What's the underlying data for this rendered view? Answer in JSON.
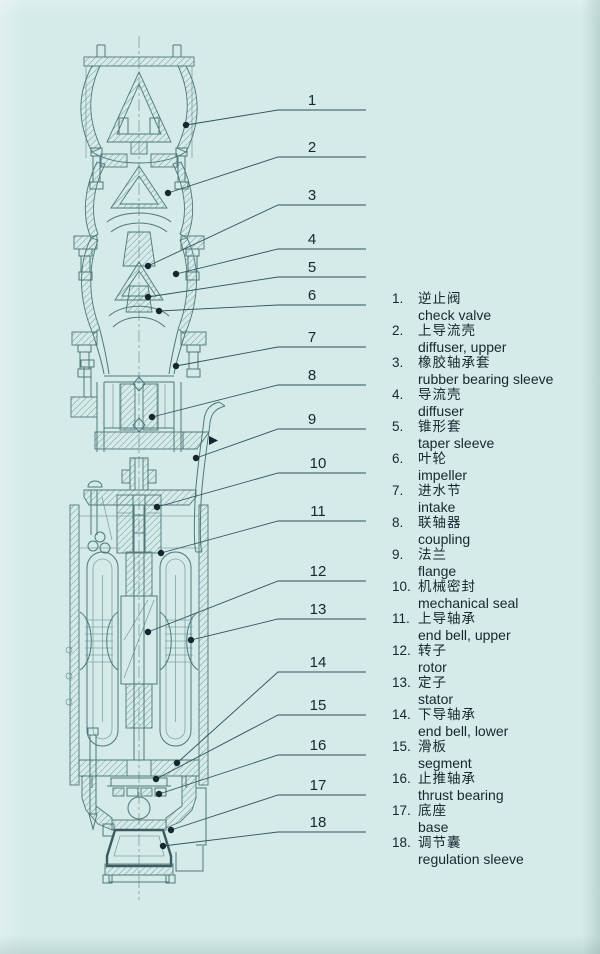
{
  "figure": {
    "kind": "submersible pump cross-section diagram",
    "colors": {
      "paper": "#d4ebe9",
      "drawing_line": "#4f7779",
      "leader_line": "#31515c",
      "text": "#17262f"
    }
  },
  "callout_numbers": [
    "1",
    "2",
    "3",
    "4",
    "5",
    "6",
    "7",
    "8",
    "9",
    "10",
    "11",
    "12",
    "13",
    "14",
    "15",
    "16",
    "17",
    "18"
  ],
  "legend": {
    "items": [
      {
        "num": "1.",
        "zh": "逆止阀",
        "en": "check valve"
      },
      {
        "num": "2.",
        "zh": "上导流壳",
        "en": "diffuser, upper"
      },
      {
        "num": "3.",
        "zh": "橡胶轴承套",
        "en": "rubber bearing sleeve"
      },
      {
        "num": "4.",
        "zh": "导流壳",
        "en": "diffuser"
      },
      {
        "num": "5.",
        "zh": "锥形套",
        "en": "taper sleeve"
      },
      {
        "num": "6.",
        "zh": "叶轮",
        "en": "impeller"
      },
      {
        "num": "7.",
        "zh": "进水节",
        "en": "intake"
      },
      {
        "num": "8.",
        "zh": "联轴器",
        "en": "coupling"
      },
      {
        "num": "9.",
        "zh": "法兰",
        "en": "flange"
      },
      {
        "num": "10.",
        "zh": "机械密封",
        "en": "mechanical seal"
      },
      {
        "num": "11.",
        "zh": "上导轴承",
        "en": "end bell, upper"
      },
      {
        "num": "12.",
        "zh": "转子",
        "en": "rotor"
      },
      {
        "num": "13.",
        "zh": "定子",
        "en": "stator"
      },
      {
        "num": "14.",
        "zh": "下导轴承",
        "en": "end bell, lower"
      },
      {
        "num": "15.",
        "zh": "滑板",
        "en": "segment"
      },
      {
        "num": "16.",
        "zh": "止推轴承",
        "en": "thrust bearing"
      },
      {
        "num": "17.",
        "zh": "底座",
        "en": "base"
      },
      {
        "num": "18.",
        "zh": "调节囊",
        "en": "regulation sleeve"
      }
    ]
  }
}
